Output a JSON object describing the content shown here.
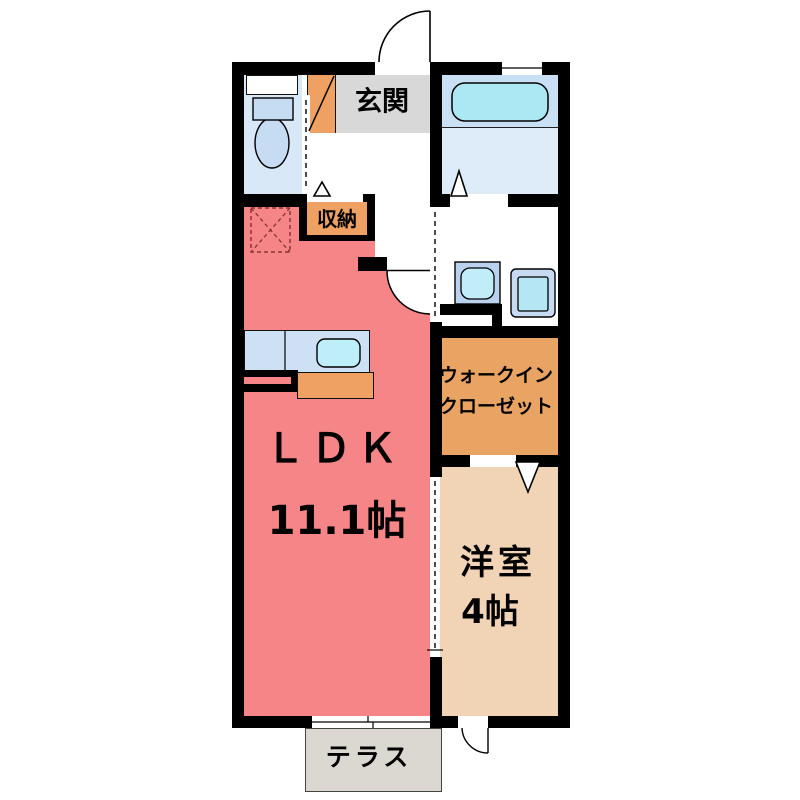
{
  "plan_title": "1LDK apartment floor plan",
  "rooms": {
    "genkan": {
      "label": "玄関"
    },
    "storage": {
      "label": "収納"
    },
    "ldk": {
      "label": "ＬＤＫ",
      "size": "11.1帖"
    },
    "wic": {
      "label_line1": "ウォークイン",
      "label_line2": "クローゼット"
    },
    "bedroom": {
      "label": "洋室",
      "size": "4帖"
    },
    "terrace": {
      "label": "テラス"
    }
  },
  "palette": {
    "wall": "#000000",
    "ldk_pink": "#F68587",
    "bedroom_beige": "#F1D3B5",
    "wic_orange": "#E9A362",
    "cabinet_orange": "#EFA163",
    "genkan_gray": "#D8D8D8",
    "terrace_gray": "#DBD7D1",
    "wet_floor_blue": "#D8E8F7",
    "bath_floor_blue": "#DEEBF9",
    "tub_cyan": "#ACE8F4",
    "counter_blue": "#CDE0F4",
    "sink_cyan": "#BEEFF8",
    "fridge_dash_red": "#8A3533"
  }
}
